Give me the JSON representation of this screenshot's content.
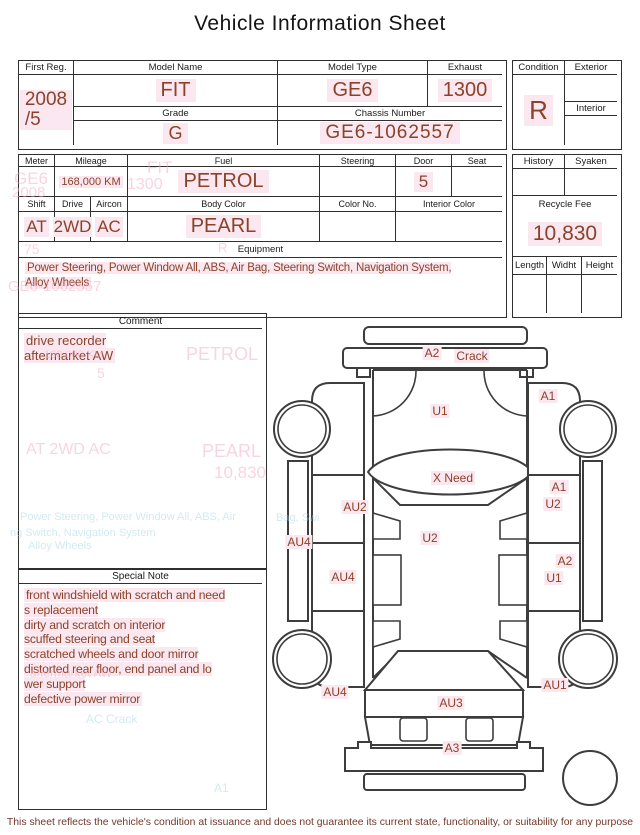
{
  "title": "Vehicle Information Sheet",
  "footer": "This sheet reflects the vehicle's condition at issuance and does not guarantee its current state, functionality, or suitability for any purpose",
  "colors": {
    "title_text": "#141414",
    "line": "#2f2f2f",
    "value_text": "#8a432a",
    "highlight": "#fbe7ef",
    "ghost_pink": "#f2aac6",
    "ghost_cyan": "#a4d6e6",
    "footer_text": "#6f382a"
  },
  "info": {
    "first_reg": {
      "label": "First Reg.",
      "value": "2008\n/5"
    },
    "model_name": {
      "label": "Model Name",
      "value": "FIT"
    },
    "model_type": {
      "label": "Model Type",
      "value": "GE6"
    },
    "exhaust": {
      "label": "Exhaust",
      "value": "1300"
    },
    "grade": {
      "label": "Grade",
      "value": "G"
    },
    "chassis_number": {
      "label": "Chassis Number",
      "value": "GE6-1062557"
    }
  },
  "condition": {
    "label": "Condition",
    "value": "R",
    "exterior_label": "Exterior",
    "exterior_value": "",
    "interior_label": "Interior",
    "interior_value": ""
  },
  "spec": {
    "meter": {
      "label": "Meter",
      "value": ""
    },
    "mileage": {
      "label": "Mileage",
      "value": "168,000 KM"
    },
    "fuel": {
      "label": "Fuel",
      "value": "PETROL"
    },
    "steering": {
      "label": "Steering",
      "value": ""
    },
    "door": {
      "label": "Door",
      "value": "5"
    },
    "seat": {
      "label": "Seat",
      "value": ""
    },
    "shift": {
      "label": "Shift",
      "value": "AT"
    },
    "drive": {
      "label": "Drive",
      "value": "2WD"
    },
    "aircon": {
      "label": "Aircon",
      "value": "AC"
    },
    "body_color": {
      "label": "Body Color",
      "value": "PEARL"
    },
    "color_no": {
      "label": "Color No.",
      "value": ""
    },
    "interior_color": {
      "label": "Interior Color",
      "value": ""
    },
    "equipment": {
      "label": "Equipment",
      "lines": [
        "Power Steering, Power Window  All, ABS, Air Bag, Steering Switch, Navigation System,",
        "Alloy Wheels"
      ]
    }
  },
  "fees": {
    "history_label": "History",
    "history_value": "",
    "syaken_label": "Syaken",
    "syaken_value": "",
    "recycle": {
      "label": "Recycle Fee",
      "value": "10,830"
    },
    "length_label": "Length",
    "length_value": "",
    "width_label": "Widht",
    "width_value": "",
    "height_label": "Height",
    "height_value": ""
  },
  "comment": {
    "header": "Comment",
    "lines": [
      "drive recorder",
      "aftermarket AW"
    ]
  },
  "special_note": {
    "header": "Special Note",
    "lines": [
      "front windshield with scratch and need",
      "s replacement",
      "dirty and scratch on interior",
      "scuffed steering and seat",
      "scratched wheels and door mirror",
      "distorted rear floor, end panel and lo",
      "wer support",
      "defective power mirror"
    ]
  },
  "diagram": {
    "labels": [
      {
        "text": "A2",
        "x": 162,
        "y": 38
      },
      {
        "text": "Crack",
        "x": 202,
        "y": 41
      },
      {
        "text": "A1",
        "x": 278,
        "y": 81
      },
      {
        "text": "U1",
        "x": 170,
        "y": 96
      },
      {
        "text": "X Need",
        "x": 183,
        "y": 163
      },
      {
        "text": "A1",
        "x": 289,
        "y": 172
      },
      {
        "text": "U2",
        "x": 283,
        "y": 189
      },
      {
        "text": "AU2",
        "x": 85,
        "y": 192
      },
      {
        "text": "U2",
        "x": 160,
        "y": 223
      },
      {
        "text": "AU4",
        "x": 29,
        "y": 227
      },
      {
        "text": "A2",
        "x": 295,
        "y": 246
      },
      {
        "text": "AU4",
        "x": 73,
        "y": 262
      },
      {
        "text": "U1",
        "x": 284,
        "y": 263
      },
      {
        "text": "AU1",
        "x": 285,
        "y": 370
      },
      {
        "text": "AU4",
        "x": 65,
        "y": 377
      },
      {
        "text": "AU3",
        "x": 181,
        "y": 388
      },
      {
        "text": "A3",
        "x": 182,
        "y": 433
      }
    ]
  },
  "ghosts": [
    {
      "text": "GE6",
      "x": 14,
      "y": 169,
      "fs": 17,
      "tone": "pink"
    },
    {
      "text": "2008",
      "x": 12,
      "y": 184,
      "fs": 15,
      "tone": "pink"
    },
    {
      "text": "FIT",
      "x": 147,
      "y": 158,
      "fs": 17,
      "tone": "pink"
    },
    {
      "text": "1300",
      "x": 127,
      "y": 176,
      "fs": 16,
      "tone": "pink"
    },
    {
      "text": "75",
      "x": 24,
      "y": 241,
      "fs": 14,
      "tone": "pink"
    },
    {
      "text": "R",
      "x": 218,
      "y": 240,
      "fs": 13,
      "tone": "pink"
    },
    {
      "text": "GE6-1062557",
      "x": 8,
      "y": 278,
      "fs": 15,
      "tone": "pink"
    },
    {
      "text": "168,000 KM",
      "x": 44,
      "y": 349,
      "fs": 11,
      "tone": "pink"
    },
    {
      "text": "PETROL",
      "x": 186,
      "y": 344,
      "fs": 18,
      "tone": "pink"
    },
    {
      "text": "5",
      "x": 97,
      "y": 365,
      "fs": 14,
      "tone": "pink"
    },
    {
      "text": "AT  2WD  AC",
      "x": 26,
      "y": 441,
      "fs": 16,
      "tone": "pink"
    },
    {
      "text": "PEARL",
      "x": 202,
      "y": 441,
      "fs": 18,
      "tone": "pink"
    },
    {
      "text": "10,830",
      "x": 214,
      "y": 463,
      "fs": 17,
      "tone": "pink"
    },
    {
      "text": "Power Steering, Power Window  All, ABS, Air",
      "x": 20,
      "y": 511,
      "fs": 11,
      "tone": "cyan"
    },
    {
      "text": "ng Switch, Navigation System",
      "x": 10,
      "y": 527,
      "fs": 11,
      "tone": "cyan"
    },
    {
      "text": "Alloy Wheels",
      "x": 28,
      "y": 540,
      "fs": 11,
      "tone": "cyan"
    },
    {
      "text": "Bag, Swi",
      "x": 276,
      "y": 512,
      "fs": 11,
      "tone": "cyan"
    },
    {
      "text": "aftermarket AW",
      "x": 30,
      "y": 666,
      "fs": 12,
      "tone": "pink"
    },
    {
      "text": "AC   Crack",
      "x": 86,
      "y": 712,
      "fs": 12,
      "tone": "cyan"
    },
    {
      "text": "A1",
      "x": 214,
      "y": 781,
      "fs": 12,
      "tone": "cyan"
    }
  ]
}
